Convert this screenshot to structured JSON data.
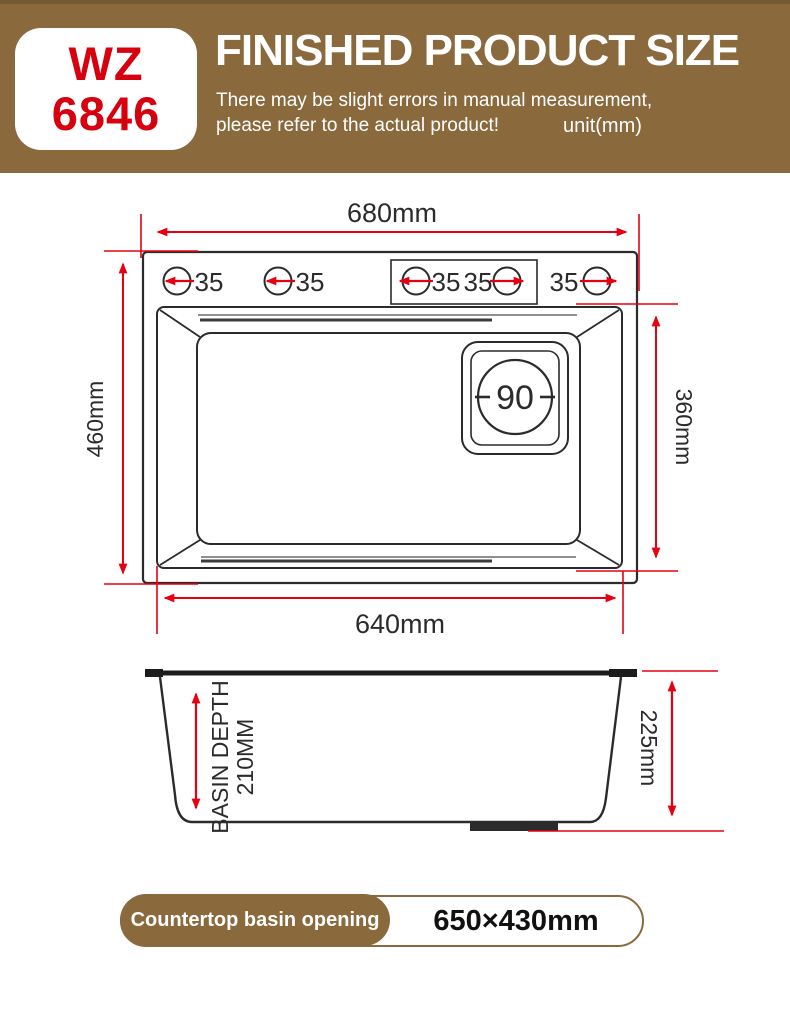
{
  "header": {
    "model_line1": "WZ",
    "model_line2": "6846",
    "title": "FINISHED PRODUCT SIZE",
    "disclaimer1": "There may be slight errors in manual measurement,",
    "disclaimer2": "please refer to the actual product!",
    "unit": "unit(mm)"
  },
  "top_view": {
    "width_overall": "680mm",
    "width_basin": "640mm",
    "depth_overall": "460mm",
    "depth_basin": "360mm",
    "hole_labels": [
      "35",
      "35",
      "35",
      "35",
      "35"
    ],
    "drain_diameter": "90"
  },
  "side_view": {
    "depth_label": "BASIN DEPTH",
    "depth_value": "210MM",
    "height": "225mm"
  },
  "footer": {
    "label": "Countertop basin opening",
    "value": "650×430mm"
  },
  "colors": {
    "brand_brown": "#8a6a3c",
    "model_red": "#d7000f",
    "dimension_red": "#e60012",
    "line_dark": "#2b2b2b"
  }
}
